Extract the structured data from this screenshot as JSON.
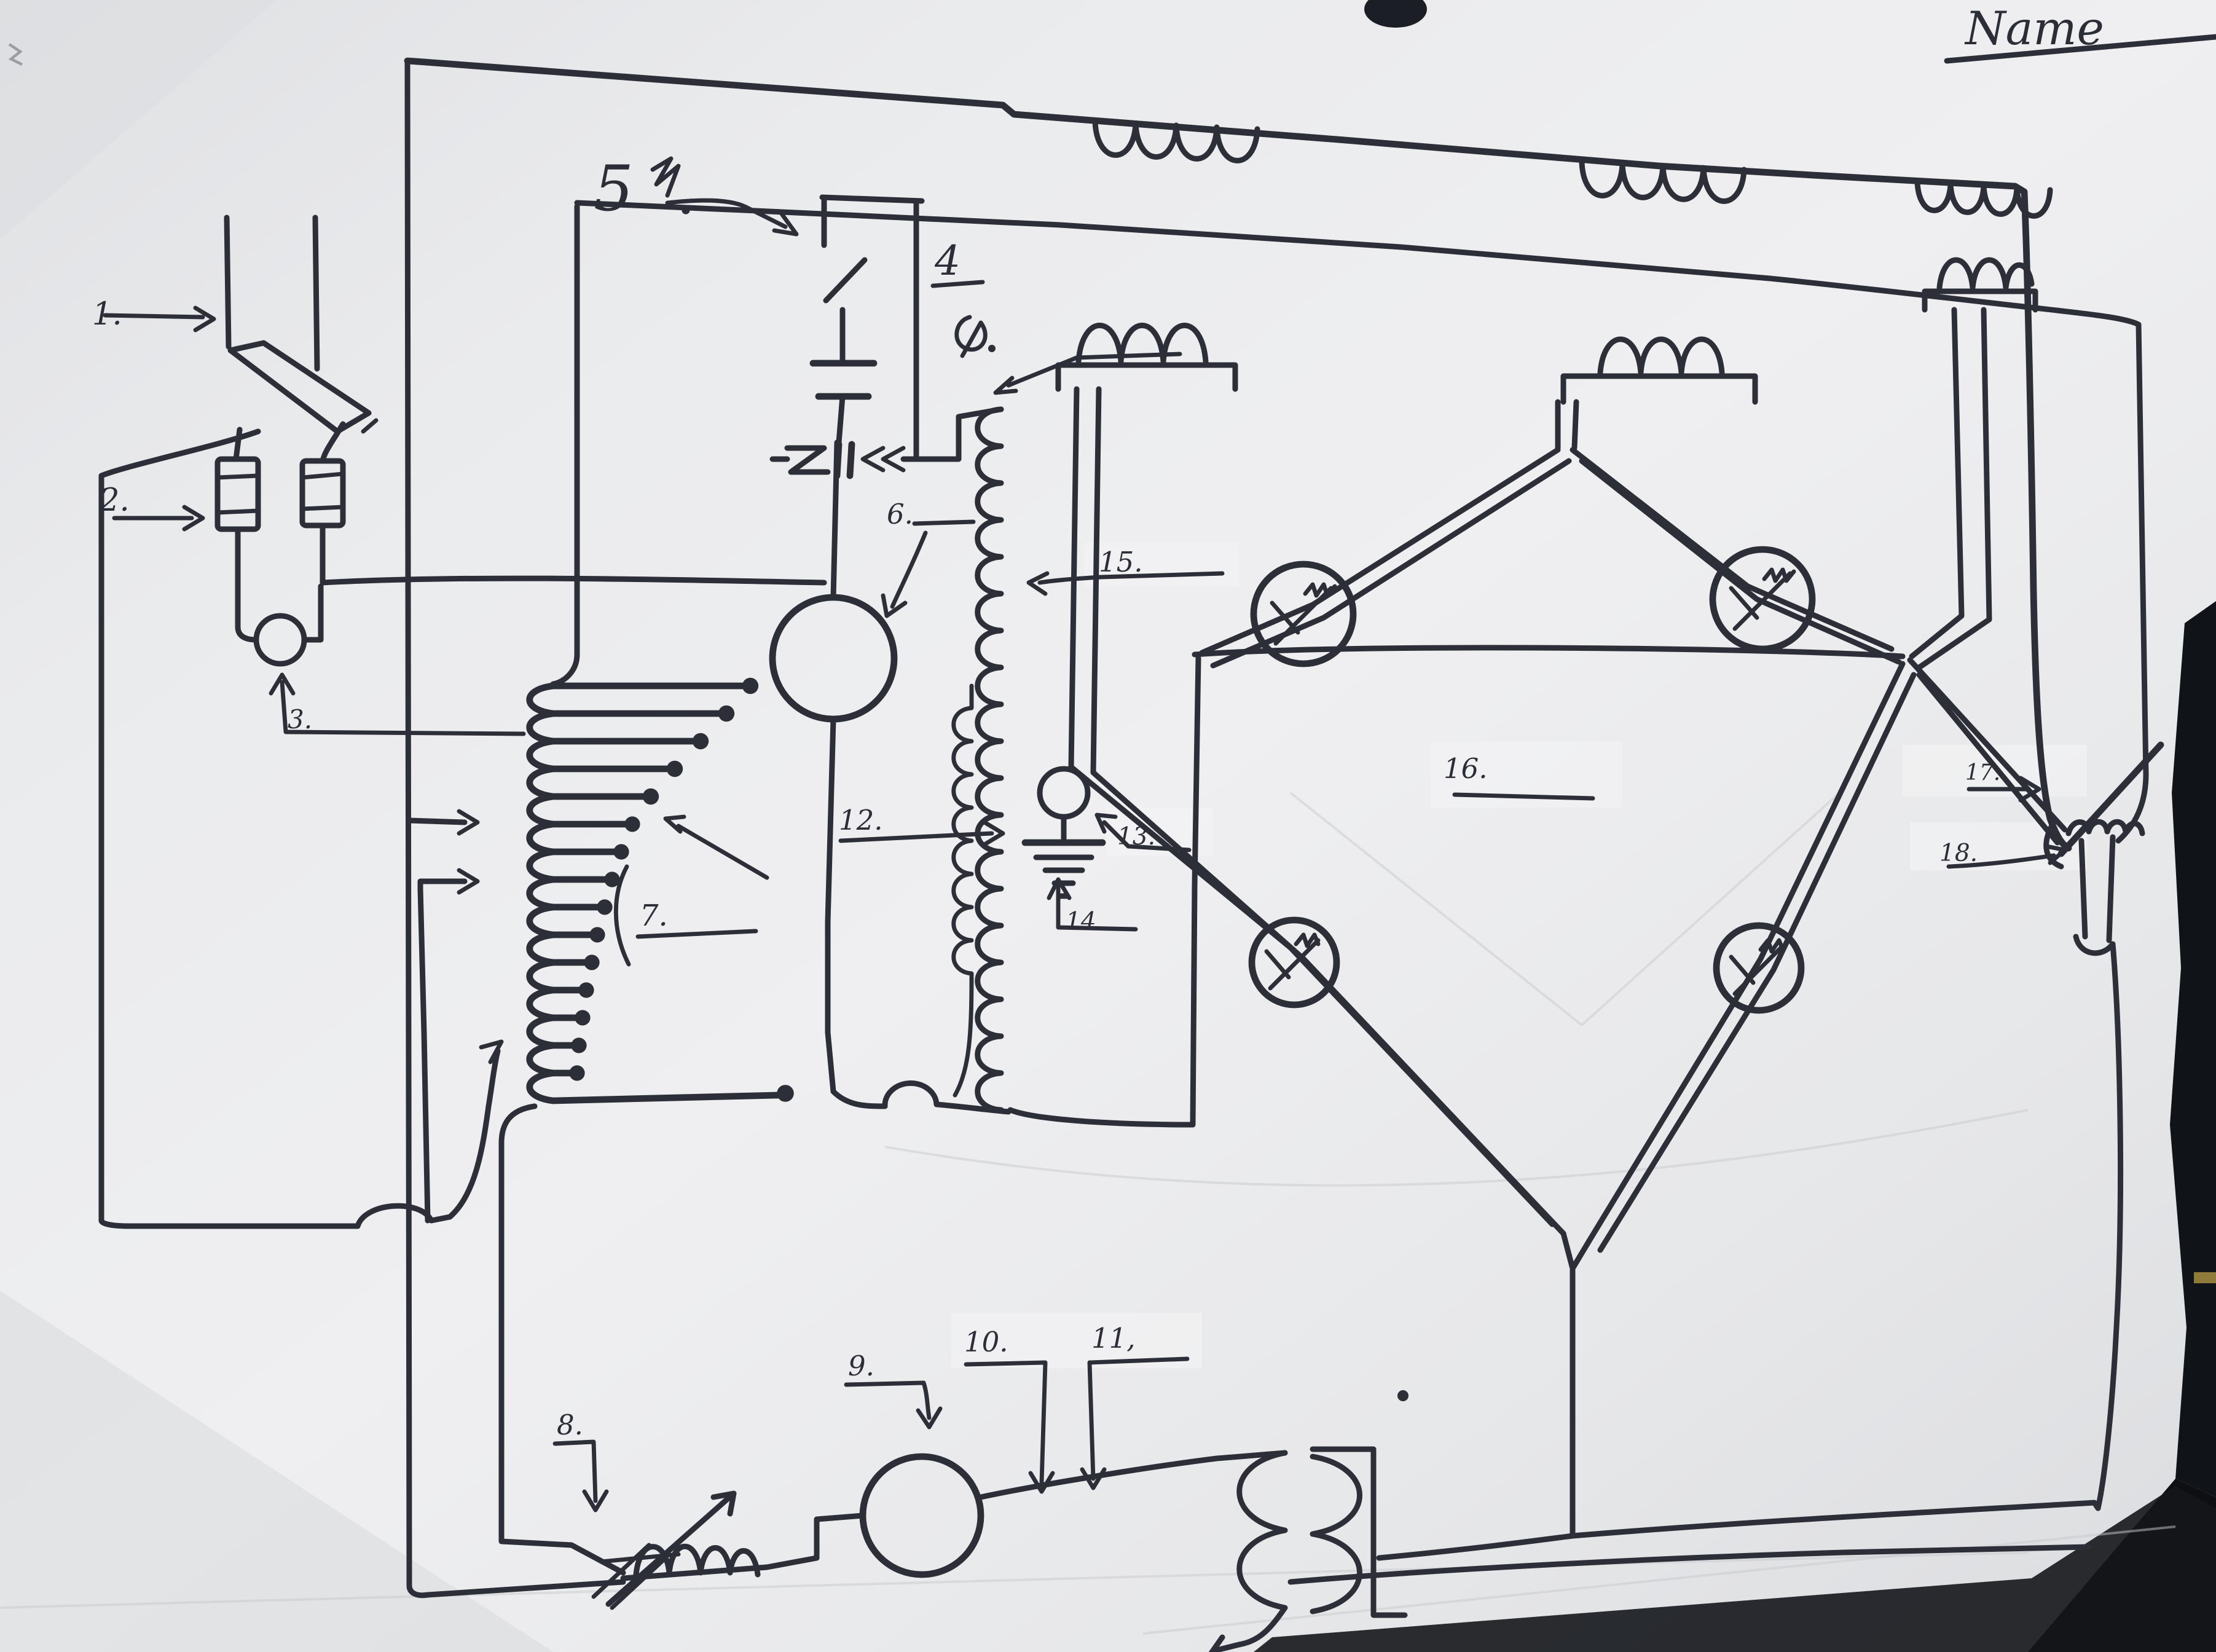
{
  "page": {
    "title_label": "Name",
    "description": "hand-drawn electrical circuit schematic on paper",
    "colors": {
      "ink": "#2d2f38",
      "paper": "#e9eaec",
      "dark_edge": "#0e1014",
      "highlight": "#f3f3f4",
      "yellow_glint": "#8f7b3a"
    }
  },
  "labels": [
    {
      "id": "1",
      "text": "1."
    },
    {
      "id": "2",
      "text": "2."
    },
    {
      "id": "3",
      "text": "3."
    },
    {
      "id": "4",
      "text": "4"
    },
    {
      "id": "5",
      "text": "5"
    },
    {
      "id": "6",
      "text": "6."
    },
    {
      "id": "7",
      "text": "7."
    },
    {
      "id": "8",
      "text": "8."
    },
    {
      "id": "9",
      "text": "9."
    },
    {
      "id": "10",
      "text": "10."
    },
    {
      "id": "11",
      "text": "11,"
    },
    {
      "id": "12",
      "text": "12."
    },
    {
      "id": "13",
      "text": "13."
    },
    {
      "id": "14",
      "text": "14."
    },
    {
      "id": "15",
      "text": "15."
    },
    {
      "id": "16",
      "text": "16."
    },
    {
      "id": "17",
      "text": "17."
    },
    {
      "id": "18",
      "text": "18."
    }
  ]
}
